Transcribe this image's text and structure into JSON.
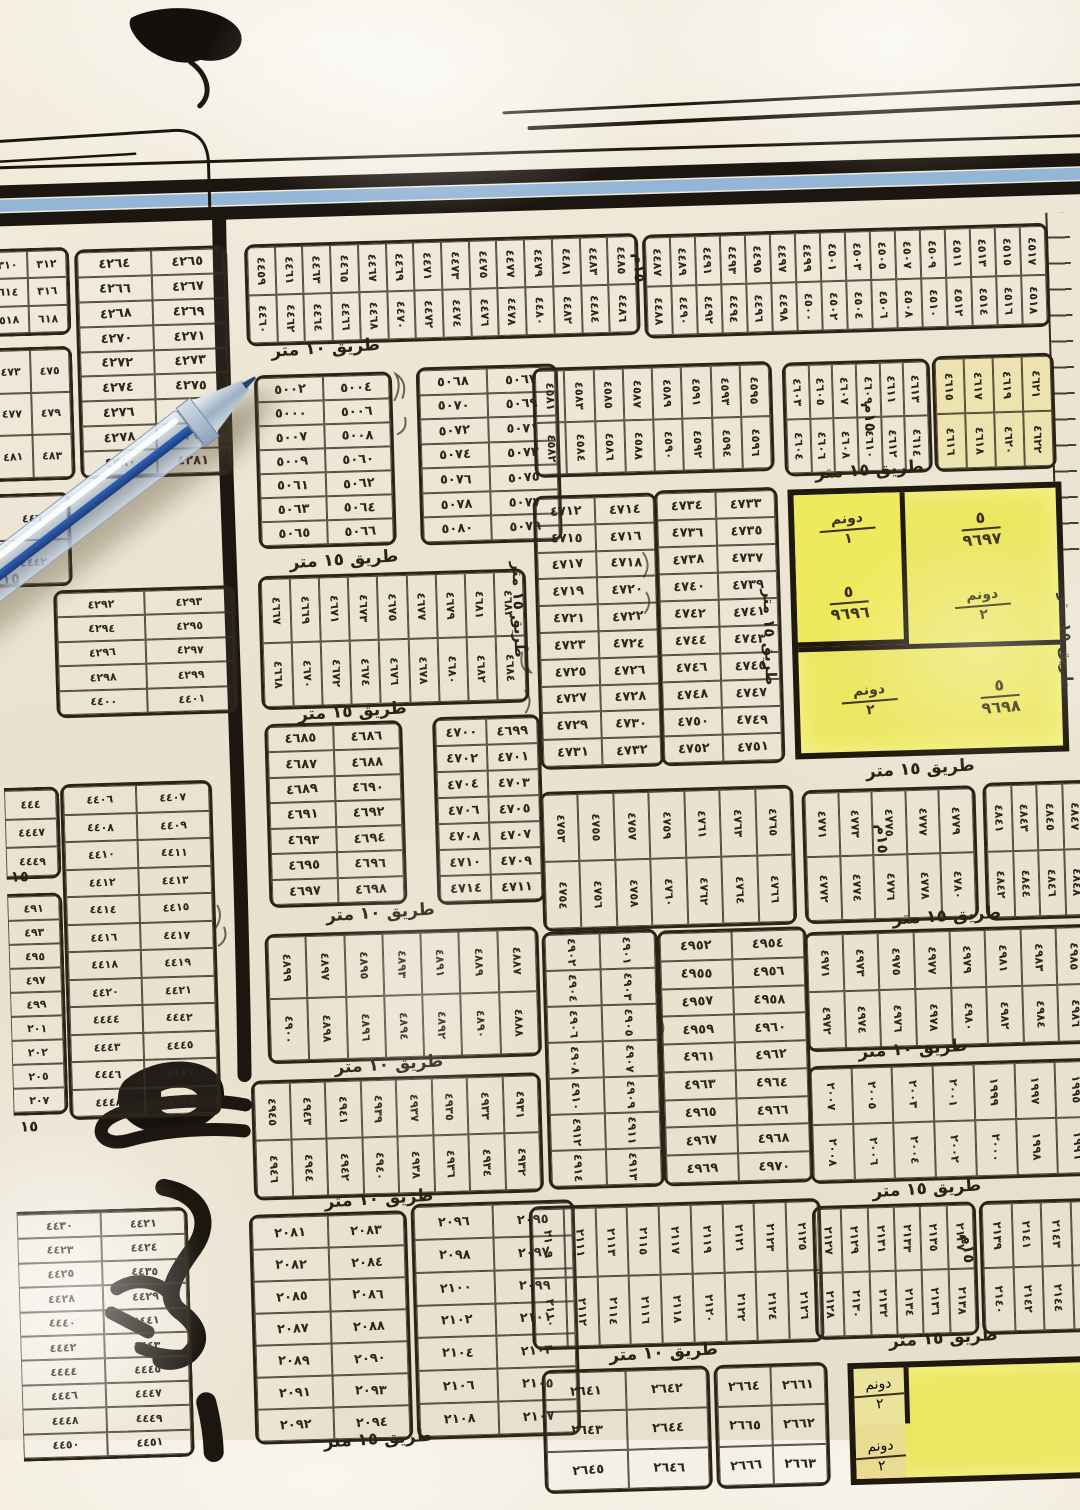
{
  "map": {
    "roads": {
      "r15": "طريق ١٥ متر",
      "r10": "طريق ١٠ متر",
      "m15": "١٥م",
      "m15_short": "١٥"
    },
    "highlight": {
      "parcels": [
        {
          "area_top": "دونم",
          "area_bottom": "١",
          "num_top": "٥",
          "number": "٩٦٩٦"
        },
        {
          "area_top": "دونم",
          "area_bottom": "٢",
          "num_top": "٥",
          "number": "٩٦٩٧"
        },
        {
          "area_top": "دونم",
          "area_bottom": "٢",
          "num_top": "٥",
          "number": "٩٦٩٨"
        }
      ],
      "bottom_parcels": [
        {
          "area_top": "دونم",
          "area_bottom": "٢"
        },
        {
          "area_top": "دونم",
          "area_bottom": "٢"
        }
      ]
    },
    "blocks": {
      "b_corner_a": {
        "rows": [
          [
            "٣١٠",
            "٣١٢"
          ],
          [
            "٦١٤",
            "٣١٦"
          ],
          [
            "٥١٨",
            "٦١٨"
          ]
        ]
      },
      "b_corner_b": {
        "rows": [
          [
            "٤٧٣",
            "٤٧٥"
          ],
          [
            "٤٧٧",
            "٤٧٩"
          ],
          [
            "٤٨١",
            "٤٨٣"
          ]
        ]
      },
      "b_corner_c": {
        "rows": [
          [
            "٤٤٦"
          ],
          [
            "٤٤٤٢"
          ]
        ]
      },
      "b_4264": {
        "rows": [
          [
            "٤٢٦٤",
            "٤٢٦٥"
          ],
          [
            "٤٢٦٦",
            "٤٢٦٧"
          ],
          [
            "٤٢٦٨",
            "٤٢٦٩"
          ],
          [
            "٤٢٧٠",
            "٤٢٧١"
          ],
          [
            "٤٢٧٢",
            "٤٢٧٣"
          ],
          [
            "٤٢٧٤",
            "٤٢٧٥"
          ],
          [
            "٤٢٧٦",
            "٤٢٧٧"
          ],
          [
            "٤٢٧٨",
            "٤٢٧٩"
          ],
          [
            "٤٢٨٠",
            "٤٢٨١"
          ]
        ]
      },
      "b_4292": {
        "rows": [
          [
            "٤٢٩٢",
            "٤٢٩٣"
          ],
          [
            "٤٢٩٤",
            "٤٢٩٥"
          ],
          [
            "٤٢٩٦",
            "٤٢٩٧"
          ],
          [
            "٤٢٩٨",
            "٤٢٩٩"
          ],
          [
            "٤٤٠٠",
            "٤٤٠١"
          ]
        ]
      },
      "b_left_a": {
        "rows": [
          [
            "٤٤٤"
          ],
          [
            "٤٤٤٧"
          ],
          [
            "٤٤٤٩"
          ]
        ]
      },
      "b_left_b": {
        "rows": [
          [
            "٤٩١"
          ],
          [
            "٤٩٣"
          ],
          [
            "٤٩٥"
          ],
          [
            "٤٩٧"
          ],
          [
            "٤٩٩"
          ],
          [
            "٢٠١"
          ],
          [
            "٢٠٢"
          ],
          [
            "٢٠٥"
          ],
          [
            "٢٠٧"
          ]
        ]
      },
      "b_4406": {
        "rows": [
          [
            "٤٤٠٦",
            "٤٤٠٧"
          ],
          [
            "٤٤٠٨",
            "٤٤٠٩"
          ],
          [
            "٤٤١٠",
            "٤٤١١"
          ],
          [
            "٤٤١٢",
            "٤٤١٣"
          ],
          [
            "٤٤١٤",
            "٤٤١٥"
          ],
          [
            "٤٤١٦",
            "٤٤١٧"
          ],
          [
            "٤٤١٨",
            "٤٤١٩"
          ],
          [
            "٤٤٢٠",
            "٤٤٢١"
          ],
          [
            "٤٤٤٤",
            "٤٤٤٢"
          ],
          [
            "٤٤٤٣",
            "٤٤٤٥"
          ],
          [
            "٤٤٤٦",
            "٤٤٤٧"
          ],
          [
            "٤٤٤٨",
            "٤٤٤٩"
          ]
        ]
      },
      "b_4420": {
        "rows": [
          [
            "٤٤٣٠",
            "٤٤٢١"
          ],
          [
            "٤٤٢٣",
            "٤٤٢٤"
          ],
          [
            "٤٤٢٥",
            "٤٤٣٥"
          ],
          [
            "٤٤٢٨",
            "٤٤٢٩"
          ],
          [
            "٤٤٤٠",
            "٤٤٤١"
          ],
          [
            "٤٤٤٢",
            "٤٤٤٣"
          ],
          [
            "٤٤٤٤",
            "٤٤٤٥"
          ],
          [
            "٤٤٤٦",
            "٤٤٤٧"
          ],
          [
            "٤٤٤٨",
            "٤٤٤٩"
          ],
          [
            "٤٤٥٠",
            "٤٤٥١"
          ]
        ]
      },
      "b_top_c": {
        "rows": [
          [
            "٤٤٥٩",
            "٤٤٦١",
            "٤٤٦٣",
            "٤٤٦٥",
            "٤٤٦٧",
            "٤٤٦٩",
            "٤٤٧١",
            "٤٤٧٣",
            "٤٤٧٥",
            "٤٤٧٧",
            "٤٤٧٩",
            "٤٤٨١",
            "٤٤٨٣",
            "٤٤٨٥"
          ],
          [
            "٤٤٦٠",
            "٤٤٦٢",
            "٤٤٦٤",
            "٤٤٦٦",
            "٤٤٦٨",
            "٤٤٧٠",
            "٤٤٧٢",
            "٤٤٧٤",
            "٤٤٧٦",
            "٤٤٧٨",
            "٤٤٨٠",
            "٤٤٨٢",
            "٤٤٨٤",
            "٤٤٨٦"
          ]
        ]
      },
      "b_top_r": {
        "rows": [
          [
            "٤٤٨٧",
            "٤٤٨٩",
            "٤٤٩١",
            "٤٤٩٣",
            "٤٤٩٥",
            "٤٤٩٧",
            "٤٤٩٩",
            "٤٥٠١",
            "٤٥٠٣",
            "٤٥٠٥",
            "٤٥٠٧",
            "٤٥٠٩",
            "٤٥١١",
            "٤٥١٣",
            "٤٥١٥",
            "٤٥١٧"
          ],
          [
            "٤٤٨٨",
            "٤٤٩٠",
            "٤٤٩٢",
            "٤٤٩٤",
            "٤٤٩٦",
            "٤٤٩٨",
            "٤٥٠٠",
            "٤٥٠٢",
            "٤٥٠٤",
            "٤٥٠٦",
            "٤٥٠٨",
            "٤٥١٠",
            "٤٥١٢",
            "٤٥١٤",
            "٤٥١٦",
            "٤٥١٨"
          ]
        ]
      },
      "b_5000_l": {
        "rows": [
          [
            "٥٠٠٢",
            "٥٠٠٤"
          ],
          [
            "٥٠٠٠",
            "٥٠٠٦"
          ],
          [
            "٥٠٠٧",
            "٥٠٠٨"
          ],
          [
            "٥٠٠٩",
            "٥٠٦٠"
          ],
          [
            "٥٠٦١",
            "٥٠٦٢"
          ],
          [
            "٥٠٦٣",
            "٥٠٦٤"
          ],
          [
            "٥٠٦٥",
            "٥٠٦٦"
          ]
        ]
      },
      "b_5000_r": {
        "rows": [
          [
            "٥٠٦٨",
            "٥٠٦٧"
          ],
          [
            "٥٠٧٠",
            "٥٠٦٩"
          ],
          [
            "٥٠٧٢",
            "٥٠٧١"
          ],
          [
            "٥٠٧٤",
            "٥٠٧٣"
          ],
          [
            "٥٠٧٦",
            "٥٠٧٥"
          ],
          [
            "٥٠٧٨",
            "٥٠٧٧"
          ],
          [
            "٥٠٨٠",
            "٥٠٧٩"
          ]
        ]
      },
      "b_strip_458": {
        "rows": [
          [
            "٤٥٨١",
            "٤٥٨٣",
            "٤٥٨٥",
            "٤٥٨٧",
            "٤٥٨٩",
            "٤٥٩١",
            "٤٥٩٣",
            "٤٥٩٥"
          ],
          [
            "٤٥٨٢",
            "٤٥٨٤",
            "٤٥٨٦",
            "٤٥٨٨",
            "٤٥٩٠",
            "٤٥٩٢",
            "٤٥٩٤",
            "٤٥٩٦"
          ]
        ]
      },
      "b_strip_460a": {
        "rows": [
          [
            "٤٦٠٣",
            "٤٦٠٥",
            "٤٦٠٧",
            "٤٦٠٩",
            "٤٦١١",
            "٤٦١٣"
          ],
          [
            "٤٦٠٤",
            "٤٦٠٦",
            "٤٦٠٨",
            "٤٦١٠",
            "٤٦١٢",
            "٤٦١٤"
          ]
        ]
      },
      "b_strip_460b": {
        "rows": [
          [
            "٤٦١٥",
            "٤٦١٧",
            "٤٦١٩",
            "٤٦٢١"
          ],
          [
            "٤٦١٦",
            "٤٦١٨",
            "٤٦٢٠",
            "٤٦٢٢"
          ]
        ]
      },
      "b_strip_466": {
        "rows": [
          [
            "٤٦٦٧",
            "٤٦٦٩",
            "٤٦٧١",
            "٤٦٧٣",
            "٤٦٧٥",
            "٤٦٧٧",
            "٤٦٧٩",
            "٤٦٨١",
            "٤٦٨٣"
          ],
          [
            "٤٦٦٨",
            "٤٦٧٠",
            "٤٦٧٢",
            "٤٦٧٤",
            "٤٦٧٦",
            "٤٦٧٨",
            "٤٦٨٠",
            "٤٦٨٢",
            "٤٦٨٤"
          ]
        ]
      },
      "b_4712_l": {
        "rows": [
          [
            "٤٧١٢",
            "٤٧١٤"
          ],
          [
            "٤٧١٥",
            "٤٧١٦"
          ],
          [
            "٤٧١٧",
            "٤٧١٨"
          ],
          [
            "٤٧١٩",
            "٤٧٢٠"
          ],
          [
            "٤٧٢١",
            "٤٧٢٢"
          ],
          [
            "٤٧٢٣",
            "٤٧٢٤"
          ],
          [
            "٤٧٢٥",
            "٤٧٢٦"
          ],
          [
            "٤٧٢٧",
            "٤٧٢٨"
          ],
          [
            "٤٧٢٩",
            "٤٧٣٠"
          ],
          [
            "٤٧٣١",
            "٤٧٣٢"
          ]
        ]
      },
      "b_4712_r": {
        "rows": [
          [
            "٤٧٣٤",
            "٤٧٣٣"
          ],
          [
            "٤٧٣٦",
            "٤٧٣٥"
          ],
          [
            "٤٧٣٨",
            "٤٧٣٧"
          ],
          [
            "٤٧٤٠",
            "٤٧٣٩"
          ],
          [
            "٤٧٤٢",
            "٤٧٤١"
          ],
          [
            "٤٧٤٤",
            "٤٧٤٣"
          ],
          [
            "٤٧٤٦",
            "٤٧٤٥"
          ],
          [
            "٤٧٤٨",
            "٤٧٤٧"
          ],
          [
            "٤٧٥٠",
            "٤٧٤٩"
          ],
          [
            "٤٧٥٢",
            "٤٧٥١"
          ]
        ]
      },
      "b_4685": {
        "rows": [
          [
            "٤٦٨٥",
            "٤٦٨٦"
          ],
          [
            "٤٦٨٧",
            "٤٦٨٨"
          ],
          [
            "٤٦٨٩",
            "٤٦٩٠"
          ],
          [
            "٤٦٩١",
            "٤٦٩٢"
          ],
          [
            "٤٦٩٣",
            "٤٦٩٤"
          ],
          [
            "٤٦٩٥",
            "٤٦٩٦"
          ],
          [
            "٤٦٩٧",
            "٤٦٩٨"
          ]
        ]
      },
      "b_4699": {
        "rows": [
          [
            "٤٧٠٠",
            "٤٦٩٩"
          ],
          [
            "٤٧٠٢",
            "٤٧٠١"
          ],
          [
            "٤٧٠٤",
            "٤٧٠٣"
          ],
          [
            "٤٧٠٦",
            "٤٧٠٥"
          ],
          [
            "٤٧٠٨",
            "٤٧٠٧"
          ],
          [
            "٤٧١٠",
            "٤٧٠٩"
          ],
          [
            "٤٧١٤",
            "٤٧١١"
          ]
        ]
      },
      "b_strip_488": {
        "rows": [
          [
            "٤٨٩٩",
            "٤٨٩٧",
            "٤٨٩٥",
            "٤٨٩٣",
            "٤٨٩١",
            "٤٨٨٩",
            "٤٨٨٧"
          ],
          [
            "٤٩٠٠",
            "٤٨٩٨",
            "٤٨٩٦",
            "٤٨٩٤",
            "٤٨٩٢",
            "٤٨٩٠",
            "٤٨٨٨"
          ]
        ]
      },
      "b_strip_493": {
        "rows": [
          [
            "٤٩٤٥",
            "٤٩٤٣",
            "٤٩٤١",
            "٤٩٣٩",
            "٤٩٣٧",
            "٤٩٣٥",
            "٤٩٣٣",
            "٤٩٣١"
          ],
          [
            "٤٩٤٦",
            "٤٩٤٤",
            "٤٩٤٢",
            "٤٩٤٠",
            "٤٩٣٨",
            "٤٩٣٦",
            "٤٩٣٤",
            "٤٩٣٢"
          ]
        ]
      },
      "b_strip_475": {
        "rows": [
          [
            "٤٧٥٣",
            "٤٧٥٥",
            "٤٧٥٧",
            "٤٧٥٩",
            "٤٧٦١",
            "٤٧٦٣",
            "٤٧٦٥"
          ],
          [
            "٤٧٥٤",
            "٤٧٥٦",
            "٤٧٥٨",
            "٤٧٦٠",
            "٤٧٦٢",
            "٤٧٦٤",
            "٤٧٦٦"
          ]
        ]
      },
      "b_4901": {
        "rows": [
          [
            "٤٩٠٢",
            "٤٩٠١"
          ],
          [
            "٤٩٠٤",
            "٤٩٠٣"
          ],
          [
            "٤٩٠٦",
            "٤٩٠٥"
          ],
          [
            "٤٩٠٨",
            "٤٩٠٧"
          ],
          [
            "٤٩١٠",
            "٤٩٠٩"
          ],
          [
            "٤٩١٢",
            "٤٩١١"
          ],
          [
            "٤٩١٤",
            "٤٩١٣"
          ]
        ]
      },
      "b_4952": {
        "rows": [
          [
            "٤٩٥٢",
            "٤٩٥٤"
          ],
          [
            "٤٩٥٥",
            "٤٩٥٦"
          ],
          [
            "٤٩٥٧",
            "٤٩٥٨"
          ],
          [
            "٤٩٥٩",
            "٤٩٦٠"
          ],
          [
            "٤٩٦١",
            "٤٩٦٢"
          ],
          [
            "٤٩٦٣",
            "٤٩٦٤"
          ],
          [
            "٤٩٦٥",
            "٤٩٦٦"
          ],
          [
            "٤٩٦٧",
            "٤٩٦٨"
          ],
          [
            "٤٩٦٩",
            "٤٩٧٠"
          ]
        ]
      },
      "b_strip_497": {
        "rows": [
          [
            "٤٩٧١",
            "٤٩٧٣",
            "٤٩٧٥",
            "٤٩٧٧",
            "٤٩٧٩",
            "٤٩٨١",
            "٤٩٨٣",
            "٤٩٨٥"
          ],
          [
            "٤٩٧٢",
            "٤٩٧٤",
            "٤٩٧٦",
            "٤٩٧٨",
            "٤٩٨٠",
            "٤٩٨٢",
            "٤٩٨٤",
            "٤٩٨٦"
          ]
        ]
      },
      "b_strip_200": {
        "rows": [
          [
            "٢٠٠٧",
            "٢٠٠٥",
            "٢٠٠٣",
            "٢٠٠١",
            "١٩٩٩",
            "١٩٩٧",
            "١٩٩٥"
          ],
          [
            "٢٠٠٨",
            "٢٠٠٦",
            "٢٠٠٤",
            "٢٠٠٢",
            "٢٠٠٠",
            "١٩٩٨",
            "١٩٩٦"
          ]
        ]
      },
      "b_strip_477": {
        "rows": [
          [
            "٤٧٧١",
            "٤٧٧٣",
            "٤٧٧٥",
            "٤٧٧٧",
            "٤٧٧٩"
          ],
          [
            "٤٧٧٢",
            "٤٧٧٤",
            "٤٧٧٦",
            "٤٧٧٨",
            "٤٧٨٠"
          ]
        ]
      },
      "b_strip_484": {
        "rows": [
          [
            "٤٨٤١",
            "٤٨٤٣",
            "٤٨٤٥",
            "٤٨٤٧"
          ],
          [
            "٤٨٤٢",
            "٤٨٤٤",
            "٤٨٤٦",
            "٤٨٤٨"
          ]
        ]
      },
      "b_2081": {
        "rows": [
          [
            "٢٠٨١",
            "٢٠٨٣"
          ],
          [
            "٢٠٨٢",
            "٢٠٨٤"
          ],
          [
            "٢٠٨٥",
            "٢٠٨٦"
          ],
          [
            "٢٠٨٧",
            "٢٠٨٨"
          ],
          [
            "٢٠٨٩",
            "٢٠٩٠"
          ],
          [
            "٢٠٩١",
            "٢٠٩٣"
          ],
          [
            "٢٠٩٢",
            "٢٠٩٤"
          ]
        ]
      },
      "b_2095": {
        "rows": [
          [
            "٢٠٩٦",
            "٢٠٩٥"
          ],
          [
            "٢٠٩٨",
            "٢٠٩٧"
          ],
          [
            "٢١٠٠",
            "٢٠٩٩"
          ],
          [
            "٢١٠٢",
            "٢١٠١"
          ],
          [
            "٢١٠٤",
            "٢١٠٣"
          ],
          [
            "٢١٠٦",
            "٢١٠٥"
          ],
          [
            "٢١٠٨",
            "٢١٠٧"
          ]
        ]
      },
      "b_strip_2109": {
        "rows": [
          [
            "٢١٠٩",
            "٢١١١",
            "٢١١٣",
            "٢١١٥",
            "٢١١٧",
            "٢١١٩",
            "٢١٢١",
            "٢١٢٣",
            "٢١٢٥"
          ],
          [
            "٢١١٠",
            "٢١١٢",
            "٢١١٤",
            "٢١١٦",
            "٢١١٨",
            "٢١٢٠",
            "٢١٢٢",
            "٢١٢٤",
            "٢١٢٦"
          ]
        ]
      },
      "b_2127": {
        "rows": [
          [
            "٢١٢٧",
            "٢١٢٩",
            "٢١٣١",
            "٢١٣٣",
            "٢١٣٥",
            "٢١٣٧"
          ],
          [
            "٢١٢٨",
            "٢١٣٠",
            "٢١٣٢",
            "٢١٣٤",
            "٢١٣٦",
            "٢١٣٨"
          ]
        ]
      },
      "b_2139": {
        "rows": [
          [
            "٢١٣٩",
            "٢١٤١",
            "٢١٤٣",
            "٢١٤٥"
          ],
          [
            "٢١٤٠",
            "٢١٤٢",
            "٢١٤٤",
            "٢١٤٦"
          ]
        ]
      },
      "b_2641": {
        "rows": [
          [
            "٢٦٤١",
            "٢٦٤٢"
          ],
          [
            "٢٦٤٣",
            "٢٦٤٤"
          ],
          [
            "٢٦٤٥",
            "٢٦٤٦"
          ]
        ]
      },
      "b_2661": {
        "rows": [
          [
            "٢٦٦٤",
            "٢٦٦١"
          ],
          [
            "٢٦٦٥",
            "٢٦٦٢"
          ],
          [
            "٢٦٦٦",
            "٢٦٦٣"
          ]
        ]
      }
    },
    "colors": {
      "paper": "#ece5d3",
      "ink": "#2e261a",
      "road_black": "#1b1510",
      "border_blue": "#8fb3d6",
      "highlight_yellow": "#ece661",
      "pen_blue": "#2f63b8"
    }
  }
}
